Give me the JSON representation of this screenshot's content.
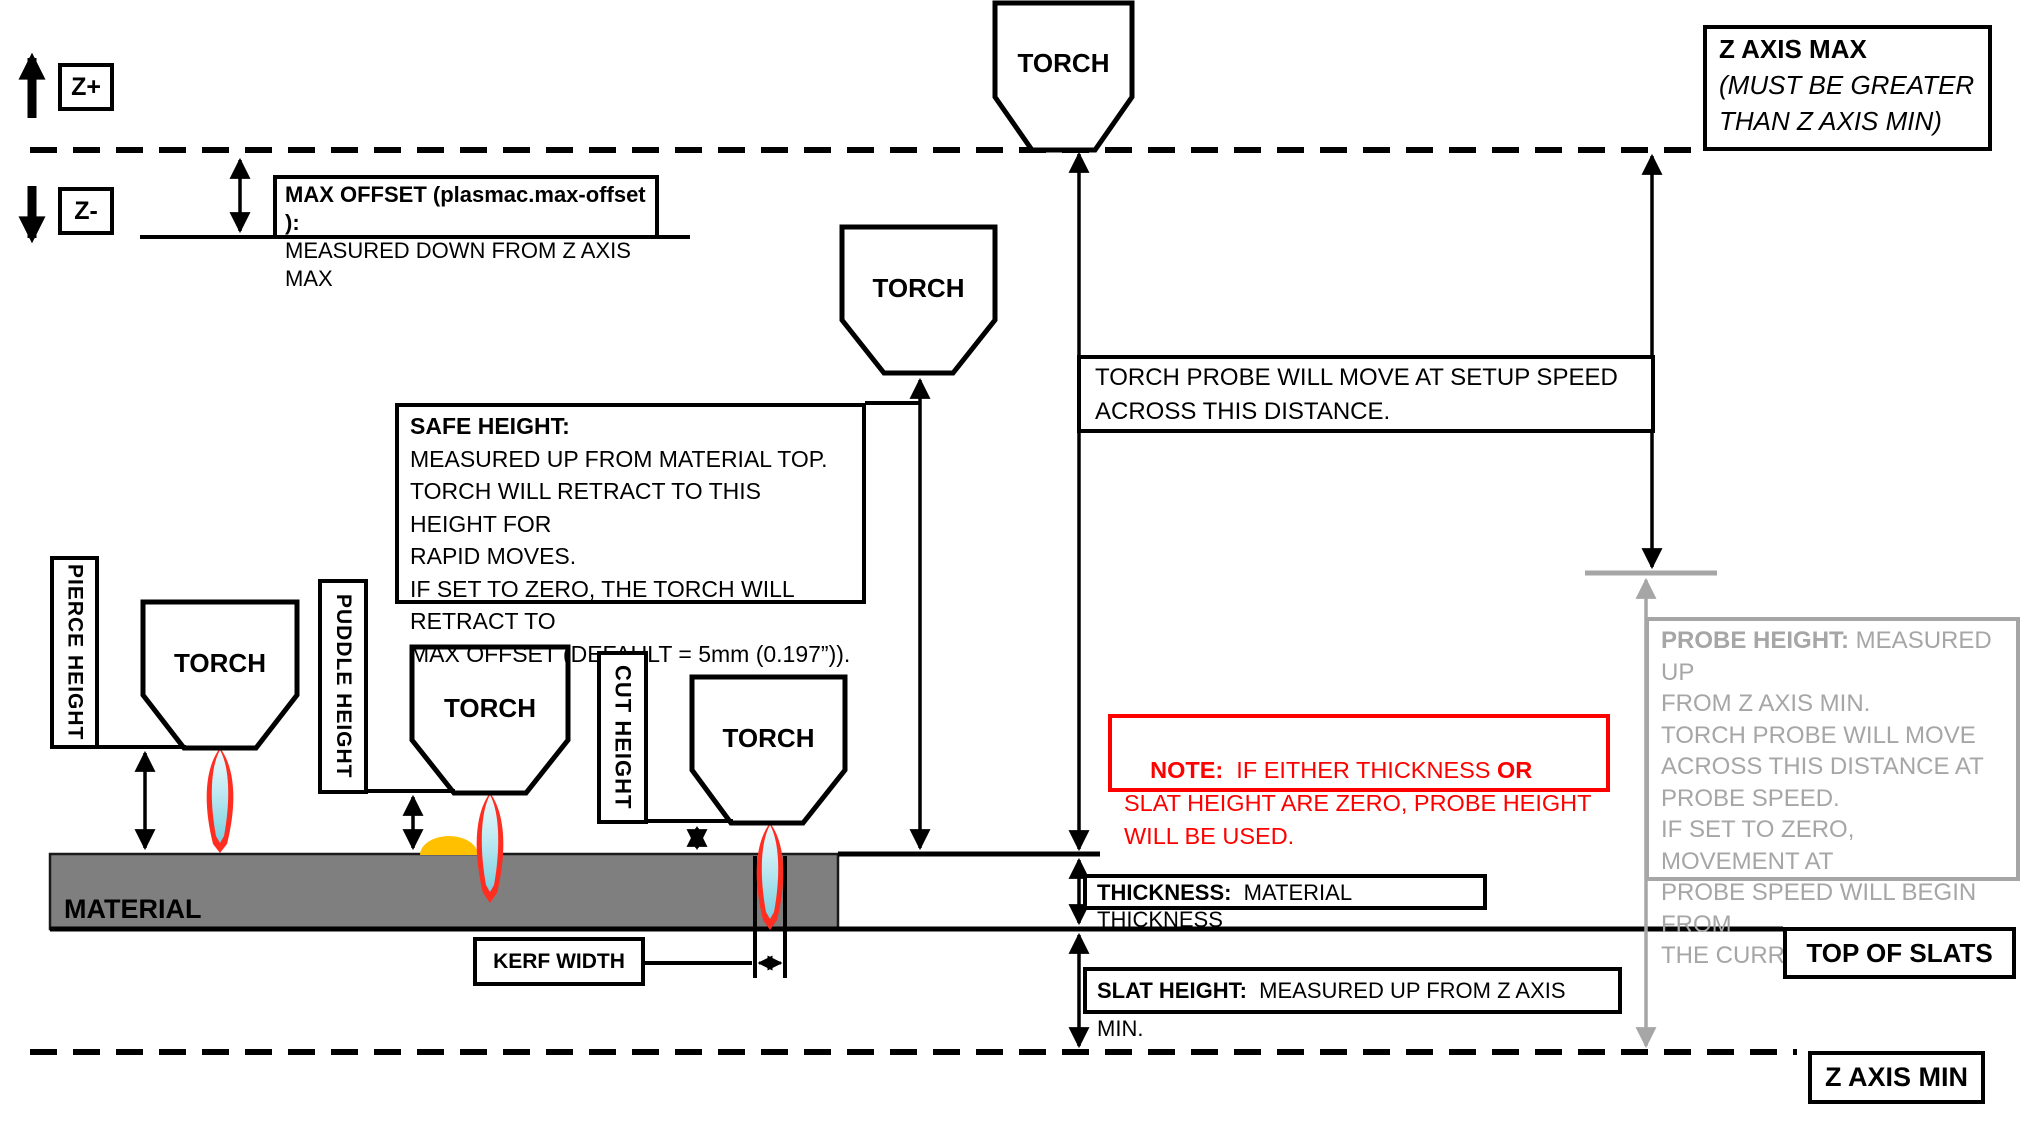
{
  "colors": {
    "material_gray": "#7f7f7f",
    "probe_gray": "#a6a6a6",
    "note_red": "#ff0000",
    "puddle_orange": "#ffc000",
    "flame_red": "#ff2e21",
    "flame_cyan": "#aadfec"
  },
  "axis": {
    "z_plus": "Z+",
    "z_minus": "Z-"
  },
  "torch_label": "TORCH",
  "boxes": {
    "max_offset": {
      "bold": "MAX OFFSET (plasmac.max-offset ):",
      "rest": "\nMEASURED DOWN FROM Z AXIS MAX"
    },
    "z_axis_max": {
      "bold": "Z AXIS MAX",
      "italic": "\n(MUST BE GREATER\nTHAN Z AXIS MIN)"
    },
    "torch_probe": {
      "text": "TORCH PROBE WILL MOVE AT SETUP SPEED\nACROSS THIS DISTANCE."
    },
    "safe_height": {
      "bold": "SAFE HEIGHT:",
      "rest": "\nMEASURED UP FROM MATERIAL TOP.\nTORCH WILL RETRACT TO THIS HEIGHT FOR\nRAPID MOVES.\nIF SET TO ZERO, THE TORCH WILL RETRACT TO\nMAX OFFSET (DEFAULT = 5mm (0.197”))."
    },
    "note": {
      "bold1": "NOTE:",
      "text1": "  IF EITHER THICKNESS ",
      "bold2": "OR",
      "text2": " SLAT HEIGHT ARE ZERO, PROBE HEIGHT WILL BE USED."
    },
    "probe_height": {
      "bold": "PROBE HEIGHT:",
      "rest": " MEASURED UP\nFROM Z AXIS MIN.\nTORCH PROBE WILL MOVE\nACROSS THIS DISTANCE AT\nPROBE SPEED.\nIF SET TO ZERO,  MOVEMENT AT\nPROBE SPEED WILL BEGIN FROM\nTHE CURRENT POSITION."
    },
    "thickness": {
      "bold": "THICKNESS:",
      "rest": "  MATERIAL THICKNESS"
    },
    "slat_height": {
      "bold": "SLAT HEIGHT:",
      "rest": "  MEASURED UP FROM Z AXIS MIN."
    },
    "kerf_width": "KERF WIDTH",
    "top_of_slats": "TOP OF SLATS",
    "z_axis_min": "Z AXIS MIN",
    "material": "MATERIAL",
    "pierce_height": "PIERCE HEIGHT",
    "puddle_height": "PUDDLE HEIGHT",
    "cut_height": "CUT HEIGHT"
  }
}
